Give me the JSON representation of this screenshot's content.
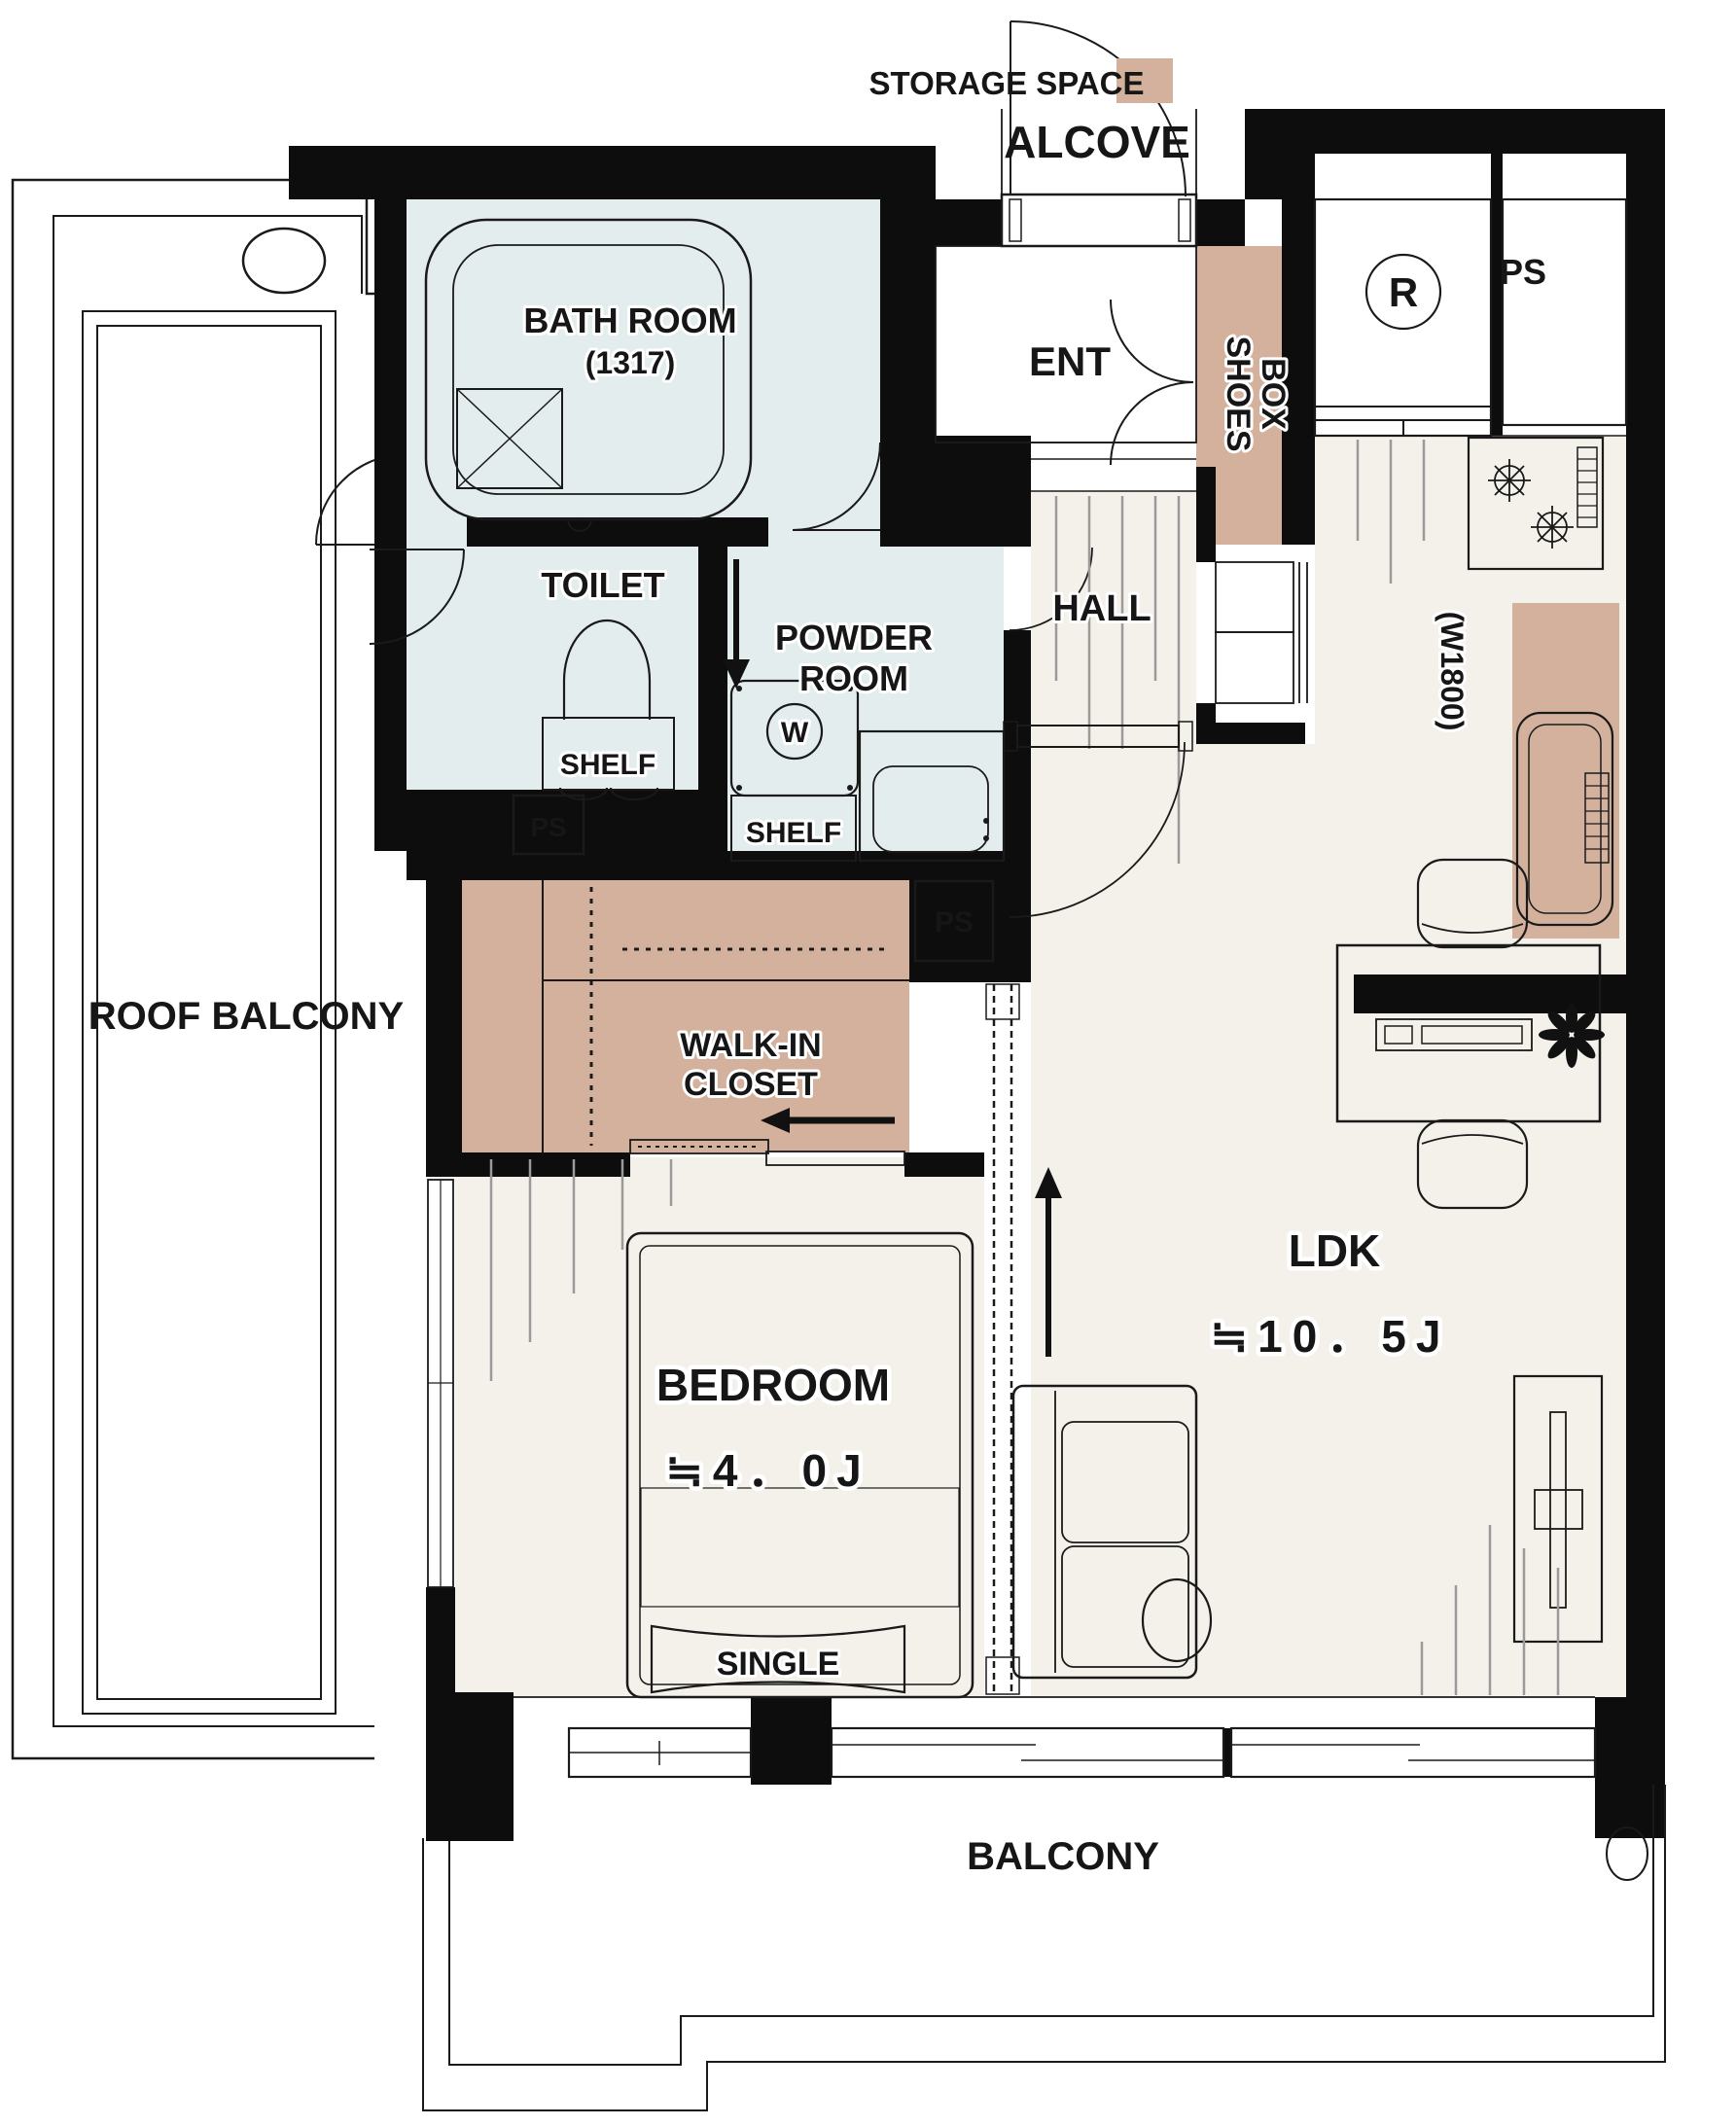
{
  "legend": {
    "storage_space": "STORAGE SPACE"
  },
  "labels": {
    "alcove": "ALCOVE",
    "ent": "ENT",
    "shoes_box_line1": "SHOES",
    "shoes_box_line2": "BOX",
    "hall": "HALL",
    "bath_room": "BATH ROOM",
    "bath_size": "(1317)",
    "toilet": "TOILET",
    "shelf_toilet": "SHELF",
    "powder_line1": "POWDER",
    "powder_line2": "ROOM",
    "shelf_powder": "SHELF",
    "washer_mark": "W",
    "fridge_mark": "R",
    "ps_toilet": "PS",
    "ps_closet": "PS",
    "ps_kitchen": "PS",
    "kitchen_width": "(W1800)",
    "walk_in_line1": "WALK-IN",
    "walk_in_line2": "CLOSET",
    "bedroom": "BEDROOM",
    "bedroom_size": "≒4．0J",
    "bed_type": "SINGLE",
    "ldk": "LDK",
    "ldk_size": "≒10．5J",
    "roof_balcony": "ROOF BALCONY",
    "balcony": "BALCONY"
  },
  "colors": {
    "storage": "#d3b19c",
    "wet_area": "#e4edee",
    "wood_floor": "#f4f1ea",
    "wall": "#0d0d0d",
    "blanket": "#e9e9e9"
  }
}
